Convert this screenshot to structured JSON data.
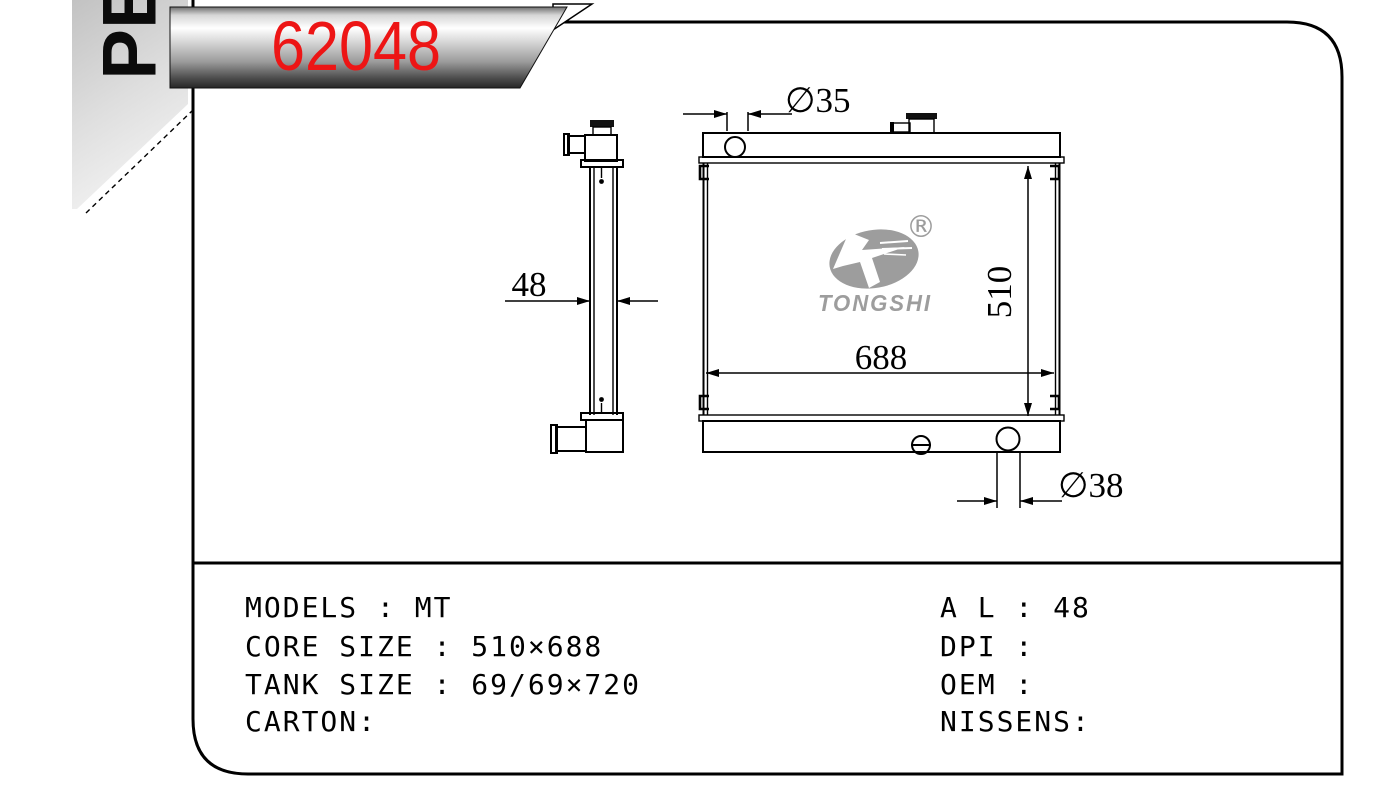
{
  "part": {
    "number": "62048",
    "ribbon": "PE"
  },
  "logo": {
    "brand": "TONGSHI",
    "registered": "®"
  },
  "dimensions": {
    "inlet_diameter": "∅35",
    "outlet_diameter": "∅38",
    "core_width": "688",
    "core_height": "510",
    "core_depth": "48"
  },
  "specs": {
    "left": [
      "MODELS : MT",
      "CORE SIZE : 510×688",
      "TANK SIZE : 69/69×720",
      "CARTON:"
    ],
    "right": [
      "A L : 48",
      "DPI :",
      "OEM :",
      "NISSENS:"
    ]
  },
  "colors": {
    "part_number_red": "#ed1515",
    "logo_gray": "#9d9d9d",
    "line_black": "#000000",
    "banner_silver_light": "#ffffff",
    "banner_silver_dark": "#262626",
    "ribbon_gray": "#c2c2c2"
  }
}
